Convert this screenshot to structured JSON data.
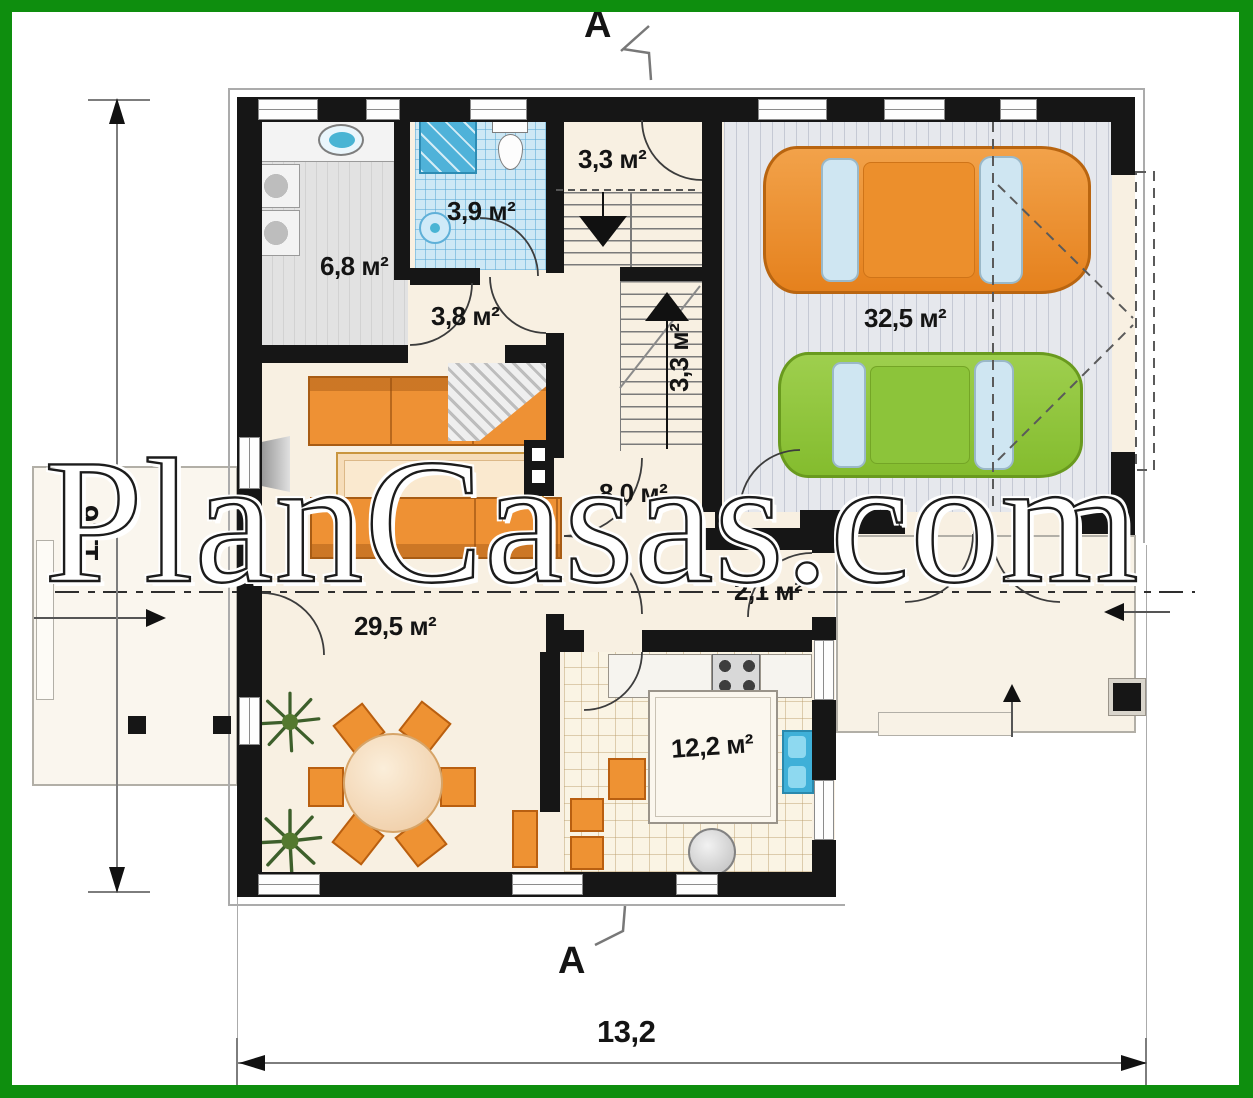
{
  "watermark": "PlanCasas.com",
  "markers": {
    "section_top": "A",
    "section_bottom": "A"
  },
  "dimensions": {
    "height": "11,6",
    "width": "13,2"
  },
  "rooms": {
    "pantry": "3,3 м²",
    "bathroom": "3,9 м²",
    "utility": "6,8 м²",
    "hall_small": "3,8 м²",
    "stairs": "3,3 м²",
    "garage": "32,5 м²",
    "hall": "8,0 м²",
    "vestibule": "2,1 м²",
    "living_room": "29,5 м²",
    "kitchen": "12,2 м²"
  },
  "colors": {
    "frame_green": "#0e8e0e",
    "wall_black": "#161616",
    "floor_cream": "#f8f0e2",
    "furniture_orange": "#ee9134",
    "car_orange": "#ed8f2e",
    "car_green": "#8cc63e",
    "water_blue": "#4ab4d6",
    "tile_blue": "#cde8f5",
    "garage_floor": "#e6e8ed"
  }
}
